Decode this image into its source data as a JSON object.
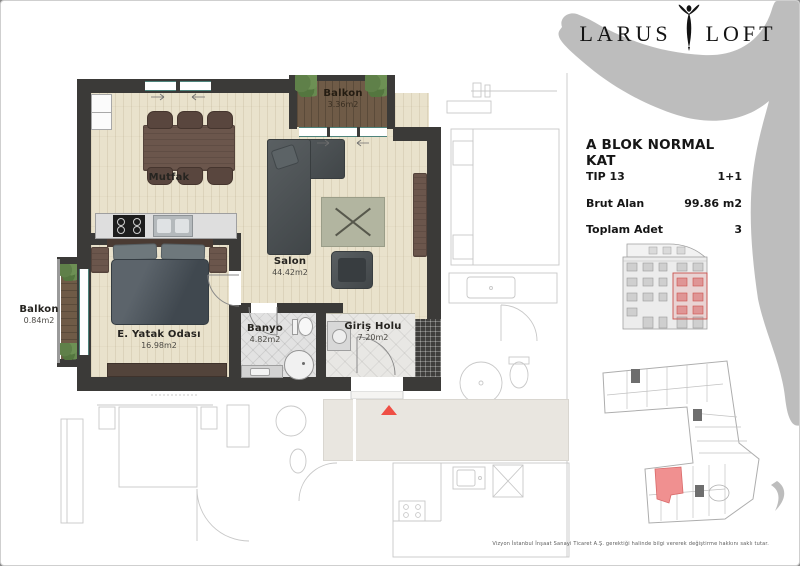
{
  "brand": {
    "name_left": "LARUS",
    "name_right": "LOFT"
  },
  "info": {
    "title": "A BLOK NORMAL KAT",
    "type_label": "TIP 13",
    "type_value": "1+1",
    "gross_area_label": "Brut Alan",
    "gross_area_value": "99.86 m2",
    "total_units_label": "Toplam Adet",
    "total_units_value": "3"
  },
  "rooms": {
    "balkon_top": {
      "name": "Balkon",
      "area": "3.36m2"
    },
    "mutfak": {
      "name": "Mutfak"
    },
    "salon": {
      "name": "Salon",
      "area": "44.42m2"
    },
    "balkon_left": {
      "name": "Balkon",
      "area": "0.84m2"
    },
    "yatak": {
      "name": "E. Yatak Odası",
      "area": "16.98m2"
    },
    "banyo": {
      "name": "Banyo",
      "area": "4.82m2"
    },
    "giris": {
      "name": "Giriş Holu",
      "area": "7.20m2"
    }
  },
  "footer": {
    "disclaimer": "Vizyon İstanbul İnşaat Sanayi Ticaret A.Ş. gerektiği halinde bilgi vererek değiştirme hakkını saklı tutar."
  },
  "colors": {
    "wall": "#3b3a38",
    "wood_floor": "#e9e2cc",
    "balcony_deck": "#6f5b47",
    "accent_red": "#ef4f45",
    "unit_highlight": "#f09090",
    "silhouette_gray": "#bdbdbd",
    "window_teal": "#4d837b"
  }
}
